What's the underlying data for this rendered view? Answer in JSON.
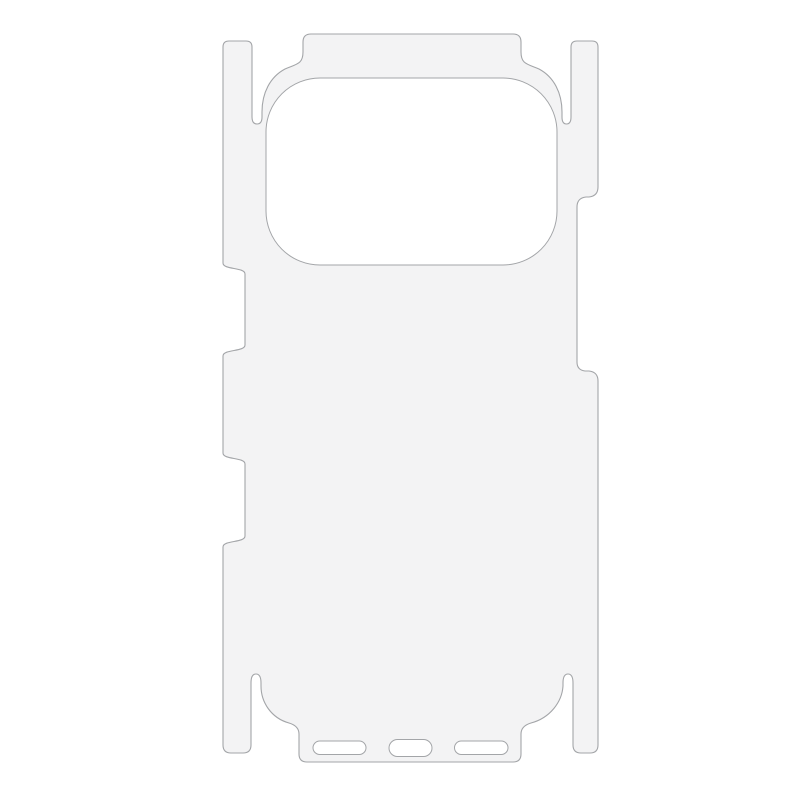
{
  "page": {
    "background_color": "#ffffff"
  },
  "product_image": {
    "subject": "Die-cut phone back protective film template",
    "film_fill_color": "#f3f3f4",
    "outline_color": "#a3a5a8",
    "cutout_fill_color": "#ffffff",
    "cutouts": {
      "camera": "camera-module-cutout",
      "bottom_left": "speaker-slot-left",
      "bottom_center": "charging-port-slot",
      "bottom_right": "speaker-slot-right"
    }
  }
}
